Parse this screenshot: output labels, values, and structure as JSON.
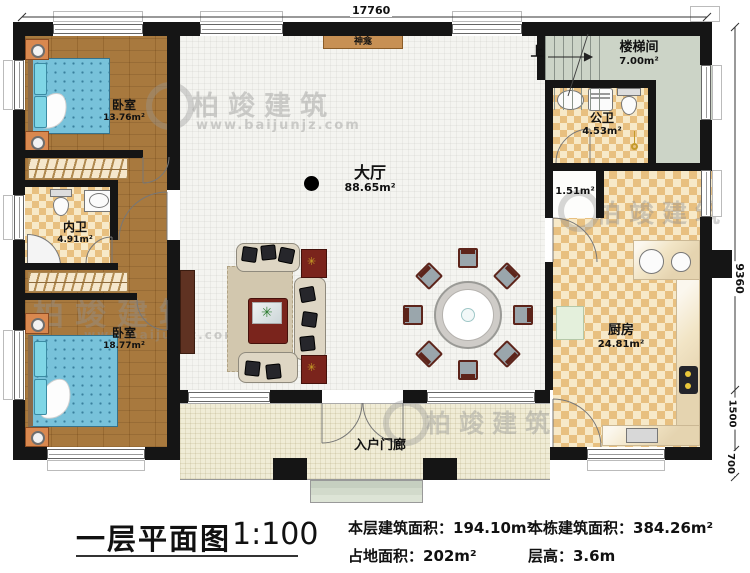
{
  "dimensions": {
    "top": "17760",
    "right_total": "9360",
    "right_porch": "1500",
    "right_step": "700",
    "small_area": "1.51m²"
  },
  "rooms": {
    "bedroom1": {
      "name": "卧室",
      "area": "13.76m²"
    },
    "inner_bath": {
      "name": "内卫",
      "area": "4.91m²"
    },
    "bedroom2": {
      "name": "卧室",
      "area": "18.77m²"
    },
    "hall": {
      "name": "大厅",
      "area": "88.65m²"
    },
    "shrine": {
      "name": "神龛"
    },
    "stairwell": {
      "name": "楼梯间",
      "area": "7.00m²",
      "up": "上"
    },
    "public_bath": {
      "name": "公卫",
      "area": "4.53m²"
    },
    "kitchen": {
      "name": "厨房",
      "area": "24.81m²"
    },
    "porch": {
      "name": "入户门廊"
    }
  },
  "watermark": {
    "brand": "柏竣建筑",
    "url": "www.baijunjz.com"
  },
  "footer": {
    "title": "一层平面图",
    "scale": "1:100",
    "line1": "本层建筑面积：194.10m²",
    "line2": "占地面积：202m²",
    "line3": "本栋建筑面积：384.26m²",
    "line4": "层高：3.6m"
  },
  "colors": {
    "wall": "#151515",
    "wood_floor": "#a8793e",
    "tile_dark": "#e8c080",
    "tile_light": "#f7e9c8",
    "stair_floor": "#ccd4c7",
    "porch_floor": "#f0ecd6",
    "bed": "#78c2da",
    "accent_red": "#7a241c"
  }
}
